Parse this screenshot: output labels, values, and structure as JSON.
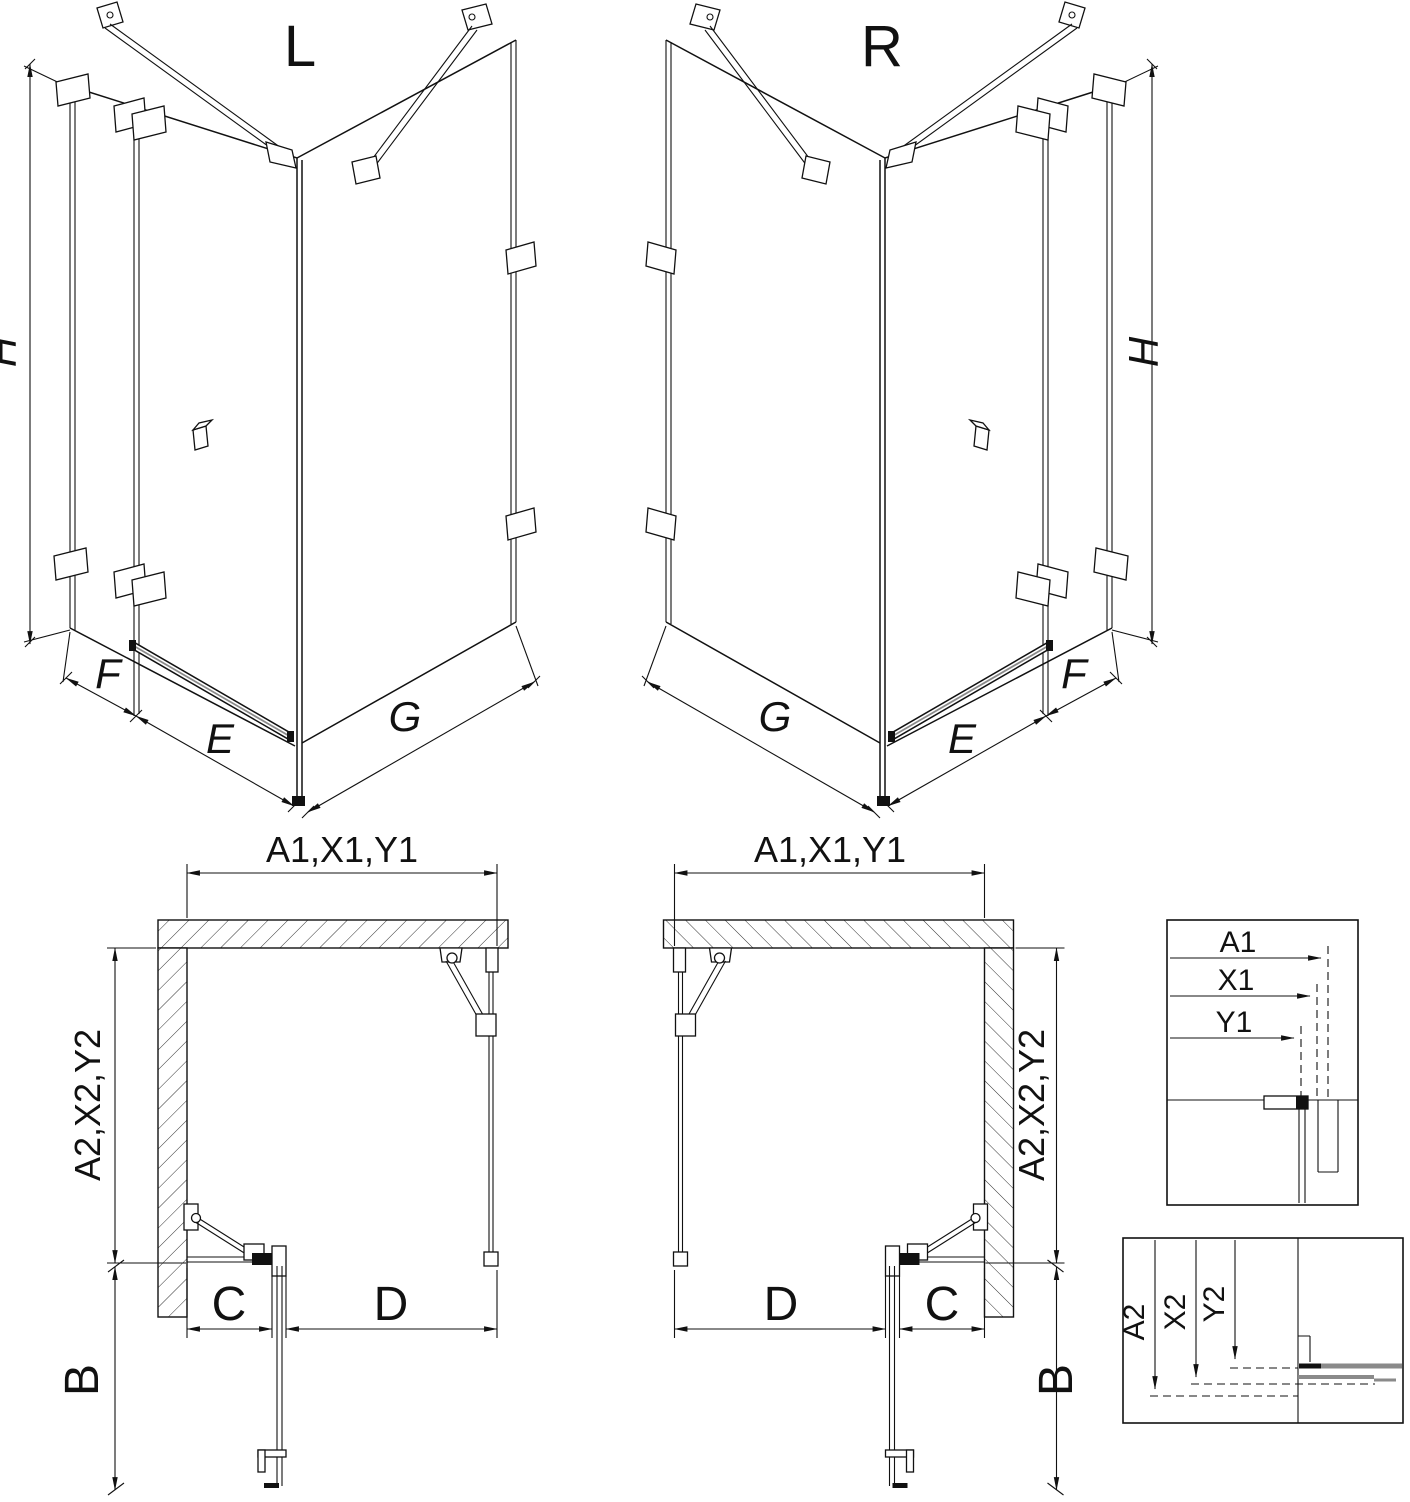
{
  "drawing": {
    "iso_left": {
      "title": "L",
      "height": "H",
      "panel_side": "F",
      "door": "E",
      "panel_return": "G"
    },
    "iso_right": {
      "title": "R",
      "height": "H",
      "panel_side": "F",
      "door": "E",
      "panel_return": "G"
    },
    "plan_left": {
      "width": "A1,X1,Y1",
      "depth": "A2,X2,Y2",
      "fixed": "C",
      "door": "D",
      "clearance": "B"
    },
    "plan_right": {
      "width": "A1,X1,Y1",
      "depth": "A2,X2,Y2",
      "fixed": "C",
      "door": "D",
      "clearance": "B"
    },
    "detail_width": {
      "labels": [
        "A1",
        "X1",
        "Y1"
      ]
    },
    "detail_depth": {
      "labels": [
        "A2",
        "X2",
        "Y2"
      ]
    },
    "colors": {
      "line": "#111111",
      "hardware": "#8a8a8a",
      "background": "#ffffff"
    }
  }
}
